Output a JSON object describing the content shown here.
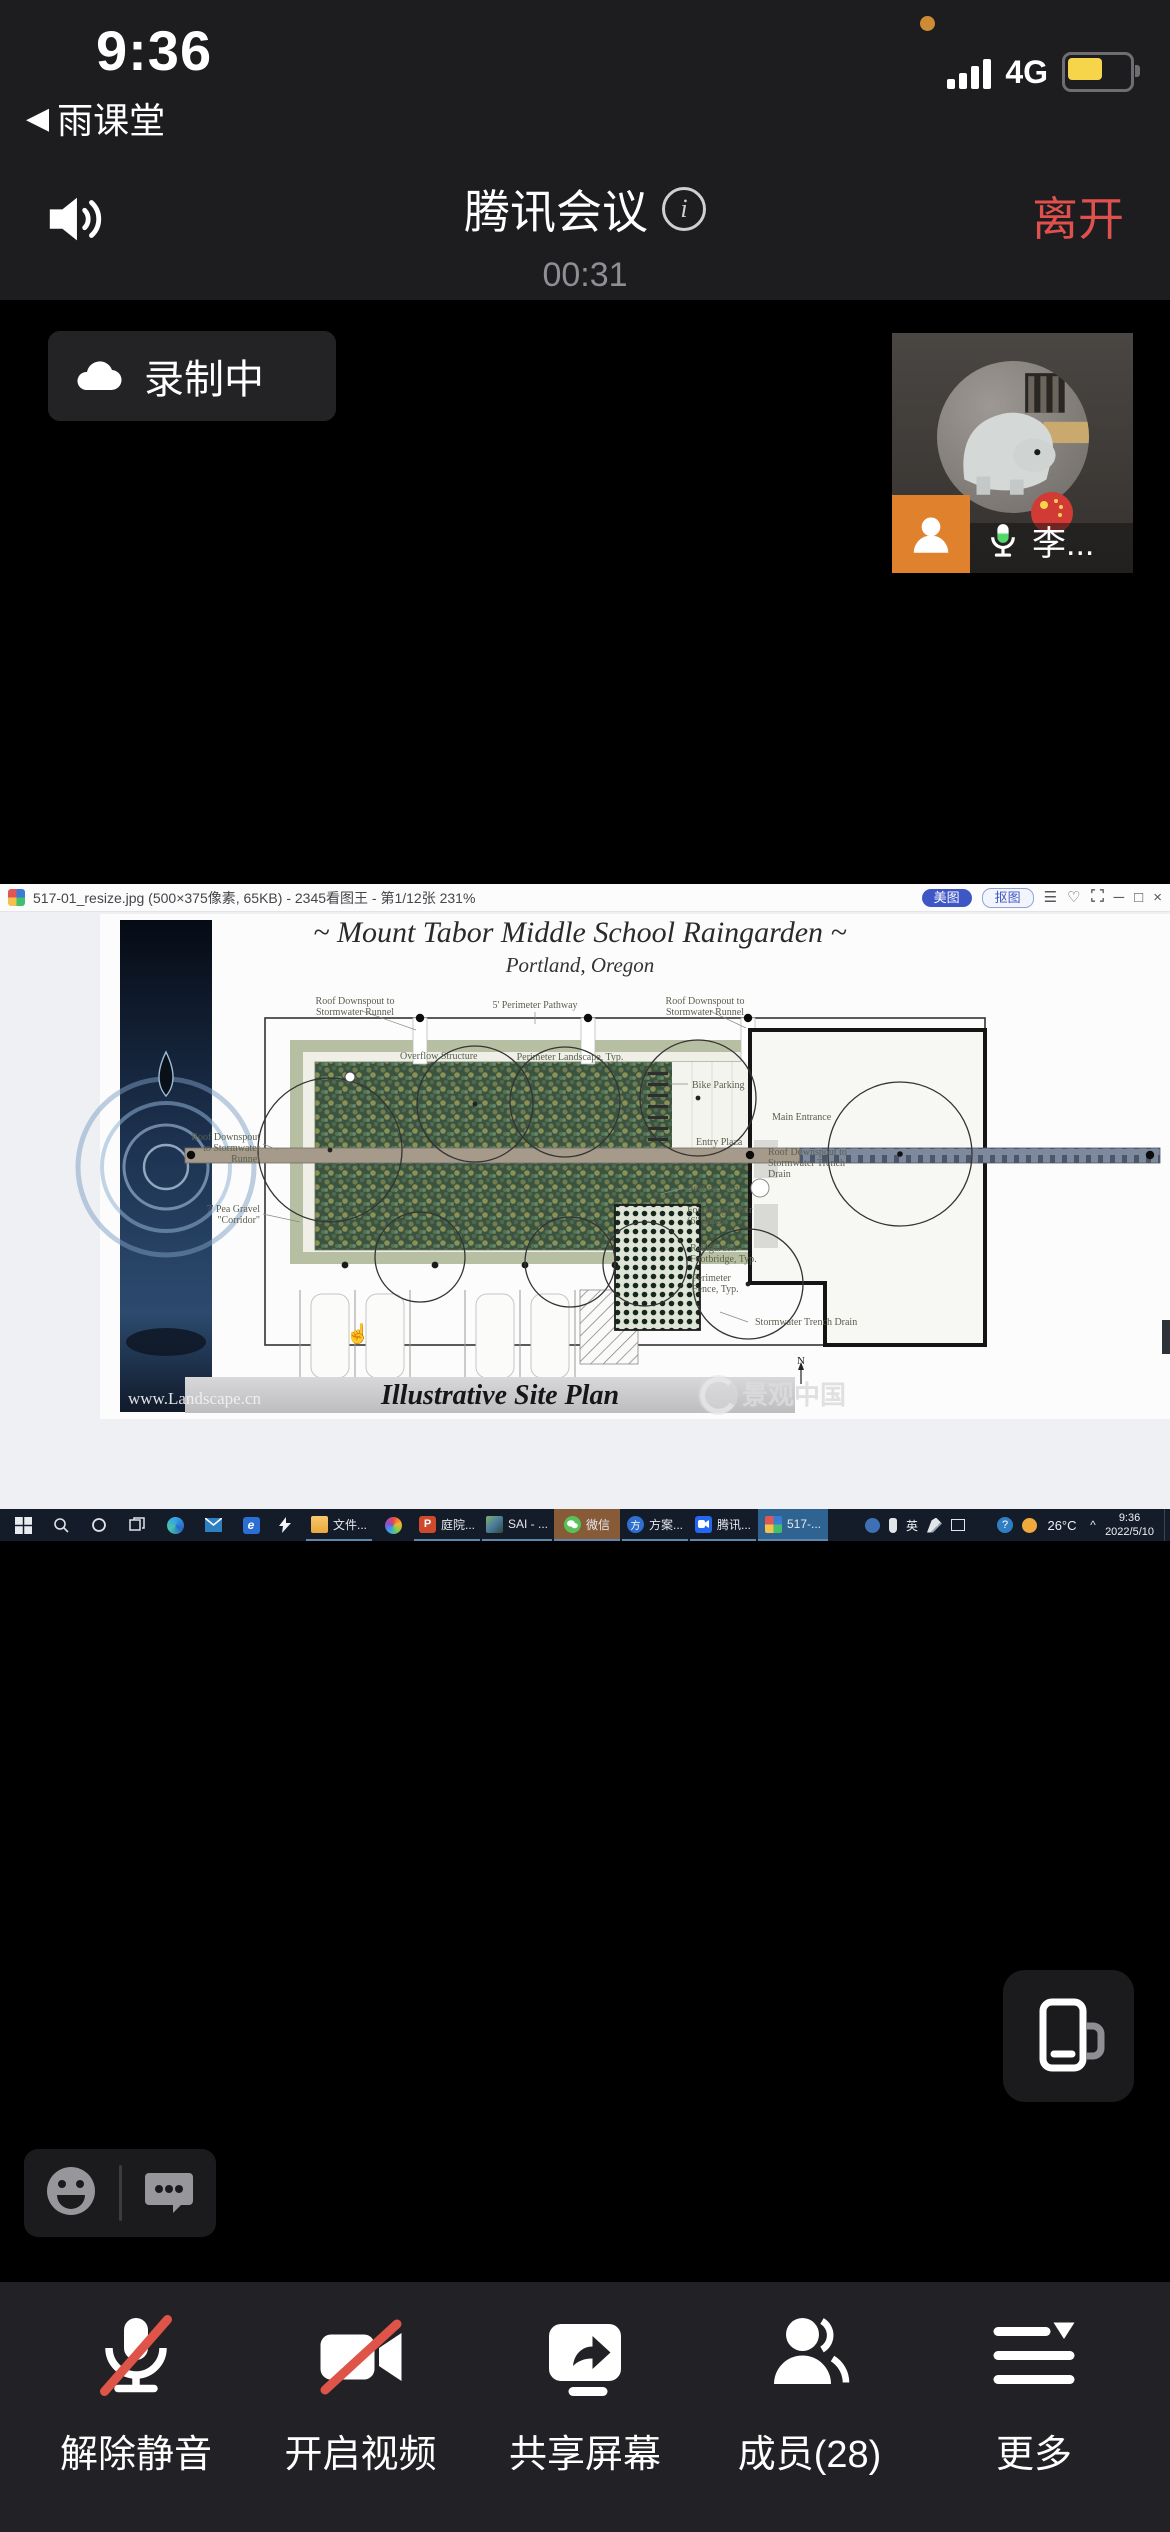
{
  "status_bar": {
    "time": "9:36",
    "back_app": "雨课堂",
    "network": "4G"
  },
  "meeting": {
    "title": "腾讯会议",
    "timer": "00:31",
    "leave_label": "离开",
    "recording_label": "录制中",
    "participant_name": "李...",
    "accent_red": "#e0514d",
    "record_orange": "#e0812e",
    "mic_green": "#52d769"
  },
  "viewer": {
    "title": "517-01_resize.jpg (500×375像素, 65KB) - 2345看图王 - 第1/12张 231%",
    "meitu_label": "美图",
    "koutu_label": "抠图",
    "controls": {
      "menu": "☰",
      "like": "♡",
      "min": "─",
      "max": "□",
      "close": "×"
    },
    "plan": {
      "title": "~ Mount Tabor Middle School Raingarden ~",
      "subtitle": "Portland, Oregon",
      "footer": "Illustrative Site Plan",
      "watermark_site": "www.Landscape.cn",
      "watermark_brand": "景观中国",
      "compass": "N",
      "labels": {
        "rd_tl1": "Roof Downspout to",
        "rd_tl2": "Stormwater Runnel",
        "pathway": "5' Perimeter Pathway",
        "rd_tr1": "Roof Downspout to",
        "rd_tr2": "Stormwater Runnel",
        "overflow": "Overflow Structure",
        "landscape": "Perimeter Landscape, Typ.",
        "bike": "Bike Parking",
        "entry": "Entry Plaza",
        "main": "Main Entrance",
        "rd_r1": "Roof Downspout to",
        "rd_r2": "Stormwater Trench",
        "rd_r3": "Drain",
        "seating": "Seating, Typ.",
        "weir1": "Footbridge Weir",
        "weir2": "(6\" depth)",
        "rgfb1": "Raingarden",
        "rgfb2": "Footbridge, Typ.",
        "fence1": "Perimeter",
        "fence2": "Fence, Typ.",
        "trench": "Stormwater Trench Drain",
        "rd_l1": "Roof Downspout",
        "rd_l2": "to Stormwater",
        "rd_l3": "Runnel",
        "pea1": "7' Pea Gravel",
        "pea2": "\"Corridor\""
      }
    }
  },
  "taskbar": {
    "apps": [
      {
        "label": "文件..."
      },
      {
        "label": "庭院..."
      },
      {
        "label": "SAI - ..."
      },
      {
        "label": "微信"
      },
      {
        "label": "方案..."
      },
      {
        "label": "腾讯..."
      },
      {
        "label": "517-..."
      }
    ],
    "tray": {
      "ime": "英",
      "temp": "26°C",
      "chevron": "^",
      "time": "9:36",
      "date": "2022/5/10"
    }
  },
  "toolbar": {
    "items": [
      {
        "label": "解除静音"
      },
      {
        "label": "开启视频"
      },
      {
        "label": "共享屏幕"
      },
      {
        "label": "成员(28)"
      },
      {
        "label": "更多"
      }
    ]
  }
}
